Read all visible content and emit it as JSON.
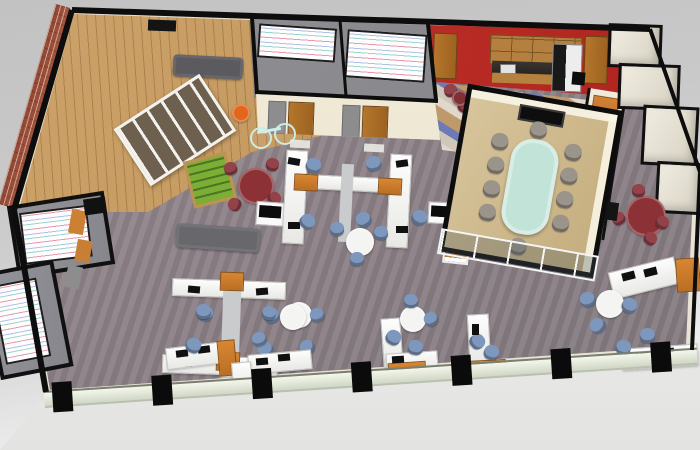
{
  "scene": {
    "description": "3D isometric rendering of an open-plan office floor, viewed from above on a gray studio backdrop",
    "background_top": "#c2c2c2",
    "background_bottom": "#fafafa"
  },
  "palette": {
    "wall_cut_black": "#0d0d0d",
    "wall_cream": "#efe9d8",
    "carpet_mauve": "#8e8388",
    "wood_floor": "#c49a62",
    "brick_red": "#a3553f",
    "accent_orange": "#cc8034",
    "kitchen_red_wall": "#c5302a",
    "chair_blue": "#7e97bd",
    "chair_maroon": "#93424a",
    "table_maroon": "#8c3136",
    "table_white": "#f4f4f2",
    "conference_table_teal": "#c2e3d8",
    "conference_floor_tan": "#d8c59c",
    "foosball_green": "#7cae36",
    "glass_band": "#e9eedd",
    "tile_blue": "#6d7ab6",
    "tile_tan": "#c0996a"
  },
  "rooms": [
    {
      "id": "brick-lounge"
    },
    {
      "id": "game-zone"
    },
    {
      "id": "meeting-room-1"
    },
    {
      "id": "meeting-room-2"
    },
    {
      "id": "kitchen"
    },
    {
      "id": "conference-room"
    },
    {
      "id": "left-huddle-room-1"
    },
    {
      "id": "left-huddle-room-2"
    },
    {
      "id": "storage-room-1"
    },
    {
      "id": "storage-room-2"
    },
    {
      "id": "storage-room-3"
    },
    {
      "id": "storage-room-4"
    },
    {
      "id": "open-office"
    }
  ],
  "furniture": [
    {
      "n": "wall-screen",
      "t": "rect",
      "x": 148,
      "y": 20,
      "w": 28,
      "h": 11,
      "rot": 2,
      "c": "#141414"
    },
    {
      "n": "sofa",
      "t": "sofa",
      "x": 173,
      "y": 56,
      "w": 70,
      "h": 22,
      "rot": 3,
      "c": "#5a5a5f"
    },
    {
      "n": "cubby-shelf",
      "t": "rack",
      "x": 124,
      "y": 96,
      "w": 96,
      "h": 62,
      "rot": -33
    },
    {
      "n": "beanbag",
      "t": "circle",
      "x": 232,
      "y": 104,
      "w": 18,
      "h": 18,
      "c": "#e2661c"
    },
    {
      "n": "bicycle-wheel",
      "t": "wheel",
      "x": 250,
      "y": 127,
      "w": 18,
      "h": 18
    },
    {
      "n": "bicycle-wheel",
      "t": "wheel",
      "x": 274,
      "y": 123,
      "w": 18,
      "h": 18
    },
    {
      "n": "bicycle-frame",
      "t": "rect",
      "x": 257,
      "y": 129,
      "w": 24,
      "h": 3,
      "rot": -10,
      "c": "#cfeee9"
    },
    {
      "n": "foosball-table",
      "t": "foos",
      "x": 188,
      "y": 156,
      "w": 38,
      "h": 42,
      "rot": -14
    },
    {
      "n": "bench-sofa",
      "t": "sofa",
      "x": 176,
      "y": 226,
      "w": 84,
      "h": 24,
      "rot": 4,
      "c": "#67676c"
    },
    {
      "n": "round-table-maroon",
      "t": "circle",
      "x": 238,
      "y": 168,
      "w": 36,
      "h": 36,
      "c": "#8c3136"
    },
    {
      "n": "chair-maroon",
      "t": "chair",
      "x": 224,
      "y": 162,
      "w": 13,
      "h": 13,
      "rot": -20,
      "c": "#93424a"
    },
    {
      "n": "chair-maroon",
      "t": "chair",
      "x": 266,
      "y": 158,
      "w": 13,
      "h": 13,
      "rot": 15,
      "c": "#93424a"
    },
    {
      "n": "chair-maroon",
      "t": "chair",
      "x": 228,
      "y": 198,
      "w": 13,
      "h": 13,
      "rot": -60,
      "c": "#93424a"
    },
    {
      "n": "chair-maroon",
      "t": "chair",
      "x": 268,
      "y": 192,
      "w": 13,
      "h": 13,
      "rot": 50,
      "c": "#93424a"
    },
    {
      "n": "printer-station",
      "t": "printer",
      "x": 256,
      "y": 202,
      "w": 32,
      "h": 22,
      "rot": 4
    },
    {
      "n": "wall-panel-orange",
      "t": "rect",
      "x": 70,
      "y": 210,
      "w": 15,
      "h": 24,
      "rot": 10,
      "c": "#cc8034"
    },
    {
      "n": "wall-panel-orange",
      "t": "rect",
      "x": 76,
      "y": 240,
      "w": 15,
      "h": 22,
      "rot": 10,
      "c": "#c87f35"
    },
    {
      "n": "wall-panel-gray",
      "t": "rect",
      "x": 66,
      "y": 266,
      "w": 15,
      "h": 22,
      "rot": 12,
      "c": "#8d8d8d"
    },
    {
      "n": "wall-corner-block",
      "t": "rect",
      "x": 84,
      "y": 198,
      "w": 22,
      "h": 16,
      "rot": -8,
      "c": "#111111"
    },
    {
      "n": "desk",
      "t": "desk",
      "x": 284,
      "y": 150,
      "w": 20,
      "h": 92,
      "rot": 3
    },
    {
      "n": "desk",
      "t": "desk",
      "x": 388,
      "y": 154,
      "w": 20,
      "h": 92,
      "rot": 3
    },
    {
      "n": "desk-beam",
      "t": "desk",
      "x": 296,
      "y": 176,
      "w": 100,
      "h": 13,
      "rot": 3
    },
    {
      "n": "cabinet-orange",
      "t": "cab",
      "x": 294,
      "y": 174,
      "w": 22,
      "h": 15,
      "rot": 3
    },
    {
      "n": "cabinet-orange",
      "t": "cab",
      "x": 378,
      "y": 178,
      "w": 22,
      "h": 15,
      "rot": 3
    },
    {
      "n": "desk-spine",
      "t": "rect",
      "x": 340,
      "y": 164,
      "w": 12,
      "h": 78,
      "rot": 3,
      "c": "#c9cbcd"
    },
    {
      "n": "monitor",
      "t": "monitor",
      "x": 288,
      "y": 158,
      "w": 12,
      "h": 7,
      "rot": 10
    },
    {
      "n": "monitor",
      "t": "monitor",
      "x": 396,
      "y": 160,
      "w": 12,
      "h": 7,
      "rot": -8
    },
    {
      "n": "monitor",
      "t": "monitor",
      "x": 288,
      "y": 222,
      "w": 12,
      "h": 7
    },
    {
      "n": "monitor",
      "t": "monitor",
      "x": 396,
      "y": 226,
      "w": 12,
      "h": 7
    },
    {
      "n": "chair-blue",
      "t": "chair",
      "x": 306,
      "y": 158,
      "w": 15,
      "h": 15,
      "rot": 20,
      "c": "#7e97bd"
    },
    {
      "n": "chair-blue",
      "t": "chair",
      "x": 366,
      "y": 156,
      "w": 15,
      "h": 15,
      "rot": -15,
      "c": "#7e97bd"
    },
    {
      "n": "chair-blue",
      "t": "chair",
      "x": 300,
      "y": 214,
      "w": 15,
      "h": 15,
      "rot": 40,
      "c": "#7e97bd"
    },
    {
      "n": "chair-blue",
      "t": "chair",
      "x": 356,
      "y": 212,
      "w": 15,
      "h": 15,
      "rot": -30,
      "c": "#7e97bd"
    },
    {
      "n": "chair-blue",
      "t": "chair",
      "x": 412,
      "y": 210,
      "w": 15,
      "h": 15,
      "rot": 25,
      "c": "#7e97bd"
    },
    {
      "n": "round-table",
      "t": "circle",
      "x": 346,
      "y": 228,
      "w": 28,
      "h": 28,
      "c": "#f4f4f2"
    },
    {
      "n": "chair-blue",
      "t": "chair",
      "x": 330,
      "y": 222,
      "w": 14,
      "h": 14,
      "c": "#7e97bd"
    },
    {
      "n": "chair-blue",
      "t": "chair",
      "x": 374,
      "y": 226,
      "w": 14,
      "h": 14,
      "c": "#7e97bd"
    },
    {
      "n": "chair-blue",
      "t": "chair",
      "x": 350,
      "y": 252,
      "w": 14,
      "h": 14,
      "c": "#7e97bd"
    },
    {
      "n": "desk",
      "t": "desk",
      "x": 172,
      "y": 280,
      "w": 112,
      "h": 16,
      "rot": 2
    },
    {
      "n": "desk",
      "t": "desk",
      "x": 162,
      "y": 356,
      "w": 114,
      "h": 17,
      "rot": 2
    },
    {
      "n": "desk-spine",
      "t": "rect",
      "x": 222,
      "y": 276,
      "w": 18,
      "h": 102,
      "rot": 2,
      "c": "#c9cbcd"
    },
    {
      "n": "cabinet-orange",
      "t": "cab",
      "x": 220,
      "y": 272,
      "w": 22,
      "h": 17,
      "rot": 2
    },
    {
      "n": "cabinet-orange",
      "t": "cab",
      "x": 216,
      "y": 352,
      "w": 22,
      "h": 17,
      "rot": 2
    },
    {
      "n": "monitor",
      "t": "monitor",
      "x": 188,
      "y": 286,
      "w": 12,
      "h": 7,
      "rot": 5
    },
    {
      "n": "monitor",
      "t": "monitor",
      "x": 256,
      "y": 288,
      "w": 12,
      "h": 7,
      "rot": -5
    },
    {
      "n": "monitor",
      "t": "monitor",
      "x": 180,
      "y": 360,
      "w": 12,
      "h": 7
    },
    {
      "n": "monitor",
      "t": "monitor",
      "x": 248,
      "y": 362,
      "w": 12,
      "h": 7
    },
    {
      "n": "chair-blue",
      "t": "chair",
      "x": 198,
      "y": 306,
      "w": 15,
      "h": 15,
      "rot": 10,
      "c": "#7e97bd"
    },
    {
      "n": "chair-blue",
      "t": "chair",
      "x": 264,
      "y": 308,
      "w": 15,
      "h": 15,
      "rot": -12,
      "c": "#7e97bd"
    },
    {
      "n": "chair-blue",
      "t": "chair",
      "x": 188,
      "y": 340,
      "w": 15,
      "h": 15,
      "rot": 30,
      "c": "#7e97bd"
    },
    {
      "n": "chair-blue",
      "t": "chair",
      "x": 258,
      "y": 342,
      "w": 15,
      "h": 15,
      "rot": -35,
      "c": "#7e97bd"
    },
    {
      "n": "round-table",
      "t": "circle",
      "x": 286,
      "y": 302,
      "w": 26,
      "h": 26,
      "c": "#f4f4f2"
    },
    {
      "n": "chair-blue",
      "t": "chair",
      "x": 310,
      "y": 308,
      "w": 14,
      "h": 14,
      "rot": -20,
      "c": "#7e97bd"
    },
    {
      "n": "desk",
      "t": "desk",
      "x": 166,
      "y": 344,
      "w": 66,
      "h": 20,
      "rot": -7
    },
    {
      "n": "cabinet-orange",
      "t": "cab",
      "x": 218,
      "y": 340,
      "w": 16,
      "h": 34,
      "rot": -5
    },
    {
      "n": "monitor",
      "t": "monitor",
      "x": 176,
      "y": 350,
      "w": 12,
      "h": 7,
      "rot": -7
    },
    {
      "n": "monitor",
      "t": "monitor",
      "x": 198,
      "y": 346,
      "w": 12,
      "h": 7,
      "rot": -7
    },
    {
      "n": "chair-blue",
      "t": "chair",
      "x": 196,
      "y": 304,
      "w": 15,
      "h": 15,
      "c": "#7e97bd"
    },
    {
      "n": "chair-blue",
      "t": "chair",
      "x": 186,
      "y": 338,
      "w": 15,
      "h": 15,
      "rot": 20,
      "c": "#7e97bd"
    },
    {
      "n": "round-table",
      "t": "circle",
      "x": 280,
      "y": 304,
      "w": 26,
      "h": 26,
      "c": "#f4f4f2"
    },
    {
      "n": "chair-blue",
      "t": "chair",
      "x": 262,
      "y": 306,
      "w": 14,
      "h": 14,
      "rot": 10,
      "c": "#7e97bd"
    },
    {
      "n": "chair-blue",
      "t": "chair",
      "x": 252,
      "y": 332,
      "w": 14,
      "h": 14,
      "rot": -20,
      "c": "#7e97bd"
    },
    {
      "n": "chair-blue",
      "t": "chair",
      "x": 300,
      "y": 340,
      "w": 14,
      "h": 14,
      "rot": -40,
      "c": "#7e97bd"
    },
    {
      "n": "desk",
      "t": "desk",
      "x": 248,
      "y": 352,
      "w": 62,
      "h": 18,
      "rot": -5
    },
    {
      "n": "monitor",
      "t": "monitor",
      "x": 256,
      "y": 358,
      "w": 12,
      "h": 7,
      "rot": -5
    },
    {
      "n": "monitor",
      "t": "monitor",
      "x": 278,
      "y": 354,
      "w": 12,
      "h": 7,
      "rot": -5
    },
    {
      "n": "desk",
      "t": "desk",
      "x": 232,
      "y": 362,
      "w": 18,
      "h": 26,
      "rot": -5
    },
    {
      "n": "desk",
      "t": "desk",
      "x": 382,
      "y": 318,
      "w": 18,
      "h": 48,
      "rot": -4
    },
    {
      "n": "desk",
      "t": "desk",
      "x": 386,
      "y": 352,
      "w": 50,
      "h": 16,
      "rot": -4
    },
    {
      "n": "cabinet-orange",
      "t": "cab",
      "x": 388,
      "y": 362,
      "w": 36,
      "h": 12,
      "rot": -4
    },
    {
      "n": "round-table",
      "t": "circle",
      "x": 400,
      "y": 306,
      "w": 26,
      "h": 26,
      "c": "#f4f4f2"
    },
    {
      "n": "chair-blue",
      "t": "chair",
      "x": 404,
      "y": 294,
      "w": 14,
      "h": 14,
      "c": "#7e97bd"
    },
    {
      "n": "chair-blue",
      "t": "chair",
      "x": 424,
      "y": 312,
      "w": 14,
      "h": 14,
      "rot": -30,
      "c": "#7e97bd"
    },
    {
      "n": "chair-blue",
      "t": "chair",
      "x": 408,
      "y": 340,
      "w": 15,
      "h": 15,
      "rot": 10,
      "c": "#7e97bd"
    },
    {
      "n": "chair-blue",
      "t": "chair",
      "x": 386,
      "y": 330,
      "w": 15,
      "h": 15,
      "rot": 30,
      "c": "#7e97bd"
    },
    {
      "n": "monitor",
      "t": "monitor",
      "x": 392,
      "y": 356,
      "w": 12,
      "h": 7,
      "rot": -4
    },
    {
      "n": "desk",
      "t": "desk",
      "x": 468,
      "y": 314,
      "w": 20,
      "h": 48,
      "rot": -3
    },
    {
      "n": "cabinet-orange",
      "t": "cab",
      "x": 466,
      "y": 360,
      "w": 38,
      "h": 12,
      "rot": -3
    },
    {
      "n": "chair-blue",
      "t": "chair",
      "x": 470,
      "y": 334,
      "w": 15,
      "h": 15,
      "rot": 50,
      "c": "#7e97bd"
    },
    {
      "n": "chair-blue",
      "t": "chair",
      "x": 484,
      "y": 345,
      "w": 15,
      "h": 15,
      "rot": 20,
      "c": "#7e97bd"
    },
    {
      "n": "monitor",
      "t": "monitor",
      "x": 472,
      "y": 324,
      "w": 7,
      "h": 11
    },
    {
      "n": "round-table-maroon",
      "t": "circle",
      "x": 626,
      "y": 196,
      "w": 40,
      "h": 40,
      "c": "#8c3136"
    },
    {
      "n": "chair-maroon",
      "t": "chair",
      "x": 612,
      "y": 212,
      "w": 13,
      "h": 13,
      "rot": -30,
      "c": "#93424a"
    },
    {
      "n": "chair-maroon",
      "t": "chair",
      "x": 656,
      "y": 216,
      "w": 13,
      "h": 13,
      "rot": 30,
      "c": "#93424a"
    },
    {
      "n": "chair-maroon",
      "t": "chair",
      "x": 632,
      "y": 184,
      "w": 13,
      "h": 13,
      "c": "#93424a"
    },
    {
      "n": "chair-maroon",
      "t": "chair",
      "x": 644,
      "y": 232,
      "w": 13,
      "h": 13,
      "rot": 40,
      "c": "#93424a"
    },
    {
      "n": "wall-display",
      "t": "rect",
      "x": 602,
      "y": 202,
      "w": 16,
      "h": 18,
      "rot": 8,
      "c": "#141414"
    },
    {
      "n": "desk",
      "t": "desk",
      "x": 610,
      "y": 264,
      "w": 66,
      "h": 26,
      "rot": -14
    },
    {
      "n": "monitor",
      "t": "monitor",
      "x": 622,
      "y": 272,
      "w": 13,
      "h": 8,
      "rot": -14
    },
    {
      "n": "monitor",
      "t": "monitor",
      "x": 644,
      "y": 268,
      "w": 13,
      "h": 8,
      "rot": -14
    },
    {
      "n": "cabinet-orange",
      "t": "cab",
      "x": 676,
      "y": 258,
      "w": 22,
      "h": 32,
      "rot": -4
    },
    {
      "n": "round-table",
      "t": "circle",
      "x": 596,
      "y": 290,
      "w": 28,
      "h": 28,
      "c": "#f4f4f2"
    },
    {
      "n": "chair-blue",
      "t": "chair",
      "x": 580,
      "y": 292,
      "w": 15,
      "h": 15,
      "rot": -20,
      "c": "#7e97bd"
    },
    {
      "n": "chair-blue",
      "t": "chair",
      "x": 622,
      "y": 298,
      "w": 15,
      "h": 15,
      "rot": 25,
      "c": "#7e97bd"
    },
    {
      "n": "chair-blue",
      "t": "chair",
      "x": 590,
      "y": 318,
      "w": 15,
      "h": 15,
      "rot": -50,
      "c": "#7e97bd"
    },
    {
      "n": "desk",
      "t": "desk",
      "x": 622,
      "y": 346,
      "w": 74,
      "h": 20,
      "rot": -4
    },
    {
      "n": "monitor",
      "t": "monitor",
      "x": 636,
      "y": 352,
      "w": 12,
      "h": 7,
      "rot": -4
    },
    {
      "n": "monitor",
      "t": "monitor",
      "x": 662,
      "y": 348,
      "w": 12,
      "h": 7,
      "rot": -4
    },
    {
      "n": "chair-blue",
      "t": "chair",
      "x": 640,
      "y": 328,
      "w": 15,
      "h": 15,
      "c": "#7e97bd"
    },
    {
      "n": "chair-blue",
      "t": "chair",
      "x": 616,
      "y": 340,
      "w": 15,
      "h": 15,
      "rot": 15,
      "c": "#7e97bd"
    },
    {
      "n": "chair-maroon",
      "t": "chair",
      "x": 444,
      "y": 84,
      "w": 13,
      "h": 13,
      "rot": -15,
      "c": "#93424a"
    },
    {
      "n": "chair-maroon",
      "t": "chair",
      "x": 458,
      "y": 100,
      "w": 13,
      "h": 13,
      "rot": 30,
      "c": "#93424a"
    },
    {
      "n": "side-table-maroon",
      "t": "circle",
      "x": 452,
      "y": 90,
      "w": 16,
      "h": 16,
      "c": "#7e3034"
    },
    {
      "n": "printer-station",
      "t": "printer",
      "x": 428,
      "y": 202,
      "w": 26,
      "h": 20,
      "rot": 3
    },
    {
      "n": "bookshelf",
      "t": "shelf",
      "x": 444,
      "y": 224,
      "w": 22,
      "h": 36,
      "rot": 6
    },
    {
      "n": "door-mat",
      "t": "mat",
      "x": 290,
      "y": 140,
      "w": 20,
      "h": 8,
      "rot": 3
    },
    {
      "n": "door-mat",
      "t": "mat",
      "x": 364,
      "y": 144,
      "w": 20,
      "h": 8,
      "rot": 3
    },
    {
      "n": "trash-bin",
      "t": "rect",
      "x": 572,
      "y": 72,
      "w": 13,
      "h": 13,
      "rot": 5,
      "c": "#0d0d0d"
    }
  ],
  "conference_room": {
    "x": 452,
    "y": 96,
    "w": 148,
    "h": 160,
    "rot": 10,
    "floor": "#d8c59c",
    "floor_dark": "#c4ad7e",
    "table": {
      "x": 50,
      "y": 38,
      "w": 48,
      "h": 96,
      "c": "#c2e3d8"
    },
    "tv": {
      "x": 50,
      "y": 6,
      "w": 42,
      "h": 12
    },
    "chair_color": "#9b948a",
    "chairs": [
      [
        28,
        38
      ],
      [
        28,
        62
      ],
      [
        28,
        86
      ],
      [
        28,
        110
      ],
      [
        102,
        36
      ],
      [
        102,
        60
      ],
      [
        102,
        84
      ],
      [
        102,
        108
      ],
      [
        64,
        20
      ],
      [
        64,
        138
      ]
    ],
    "glass": {
      "height": 22
    }
  },
  "glass_wall": {
    "x": 44,
    "y": 391,
    "len": 654,
    "h": 13,
    "angle": -3.8,
    "columns": [
      8,
      108,
      208,
      308,
      408,
      508,
      608
    ]
  }
}
